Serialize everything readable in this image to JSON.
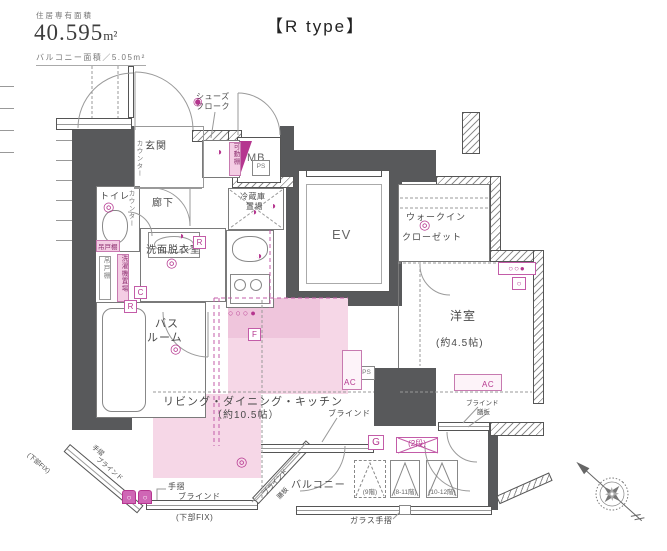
{
  "header": {
    "area_label": "住居専有面積",
    "area_value": "40.595",
    "area_unit": "m²",
    "balcony_label": "バルコニー面積／5.05m²"
  },
  "title": "【R type】",
  "rooms": {
    "genkan": "玄関",
    "shoes_closet_1": "シューズ",
    "shoes_closet_2": "クローク",
    "movable_shelf": "可動棚",
    "mb": "MB",
    "ps": "PS",
    "hallway": "廊下",
    "counter": "カウンター",
    "toilet": "トイレ",
    "hanging_cupboard": "吊戸棚",
    "washer_place": "洗濯機置場",
    "washroom": "洗面脱衣室",
    "bath_1": "バス",
    "bath_2": "ルーム",
    "fridge_1": "冷蔵庫",
    "fridge_2": "置場",
    "elevator": "EV",
    "wic_1": "ウォークイン",
    "wic_2": "クローゼット",
    "western_room": "洋室",
    "western_room_size": "(約4.5帖)",
    "ldk": "リビング・ダイニング・キッチン",
    "ldk_size": "（約10.5帖）",
    "balcony": "バルコニー"
  },
  "annotations": {
    "ac": "AC",
    "g": "G",
    "f": "F",
    "r": "R",
    "c": "C",
    "blind": "ブラインド",
    "handrail": "手摺",
    "sill_board": "膳板",
    "lower_fix": "(下部FIX)",
    "glass_handrail": "ガラス手摺",
    "two_tier": "(2段)",
    "floor9": "(9階)",
    "floor8_11": "(8-11階)",
    "floor10_12": "(10-12階)"
  },
  "icons": {
    "ceiling_light": "◎",
    "outlet_filled": "●",
    "outlet_open": "○",
    "outlet_half": "◑",
    "bell": "◉"
  },
  "colors": {
    "wall": "#58595b",
    "accent_magenta": "#b5368f",
    "highlight_pink": "#f6d7e7",
    "ac_pink": "#c35ca8"
  }
}
